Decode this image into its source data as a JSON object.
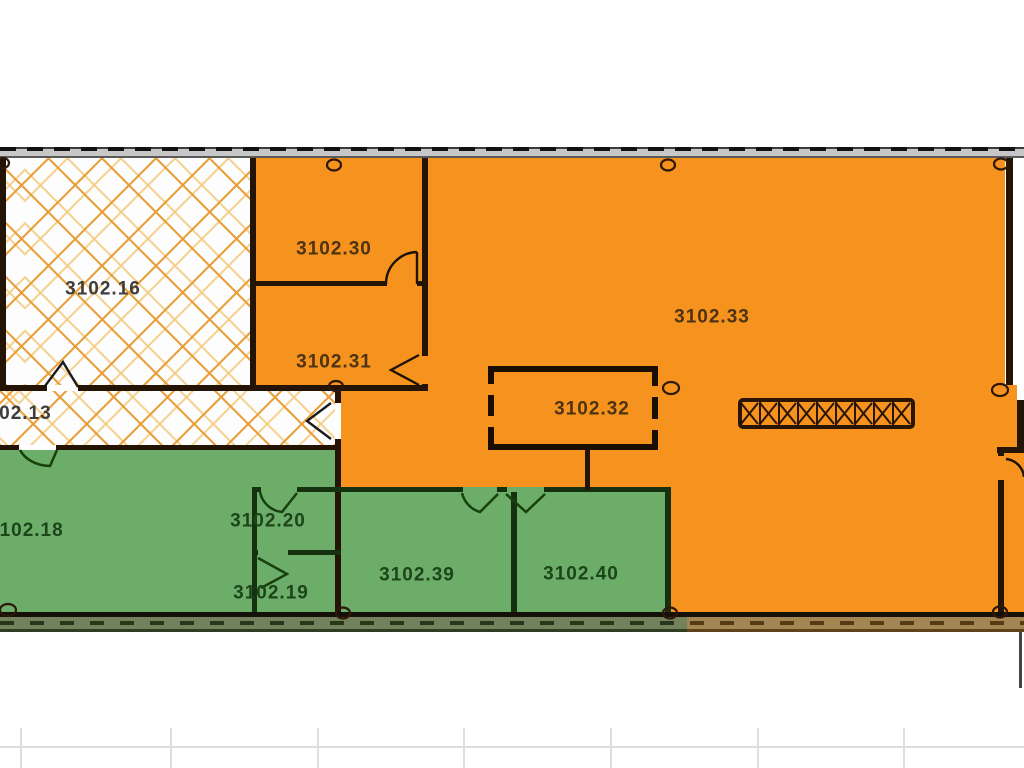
{
  "rooms": [
    {
      "id": "3102.16",
      "label": "3102.16",
      "zone": "hatched"
    },
    {
      "id": "3102.30",
      "label": "3102.30",
      "zone": "orange"
    },
    {
      "id": "3102.31",
      "label": "3102.31",
      "zone": "orange"
    },
    {
      "id": "3102.33",
      "label": "3102.33",
      "zone": "orange"
    },
    {
      "id": "3102.32",
      "label": "3102.32",
      "zone": "orange-inner"
    },
    {
      "id": "3102.13",
      "label": "3102.13",
      "zone": "hatched-corridor"
    },
    {
      "id": "3102.18",
      "label": "3102.18",
      "zone": "green"
    },
    {
      "id": "3102.20",
      "label": "3102.20",
      "zone": "green"
    },
    {
      "id": "3102.19",
      "label": "3102.19",
      "zone": "green"
    },
    {
      "id": "3102.39",
      "label": "3102.39",
      "zone": "green"
    },
    {
      "id": "3102.40",
      "label": "3102.40",
      "zone": "green"
    }
  ],
  "colors": {
    "orange": "#F6921E",
    "green": "#6CAE69",
    "hatch": "#E79C33",
    "wall_dark": "#241405",
    "wall_green": "#16310F"
  }
}
